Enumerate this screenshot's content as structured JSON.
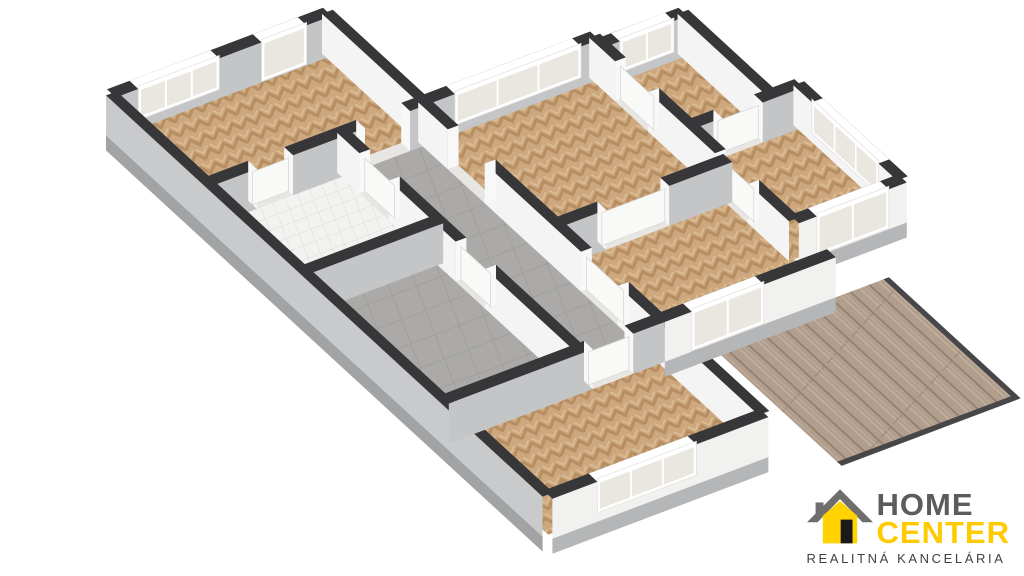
{
  "branding": {
    "line1": "HOME",
    "line2": "CENTER",
    "tagline": "REALITNÁ KANCELÁRIA",
    "colors": {
      "home_gray": "#5C5C5C",
      "center_yellow": "#FFCB00",
      "tagline_dark": "#3F3F3F",
      "roof_gray": "#6E6E6E",
      "house_yellow": "#FFD200",
      "door_black": "#1A1A1A"
    }
  },
  "floorplan": {
    "projection": {
      "origin": [
        95,
        130
      ],
      "u": [
        0.9,
        -0.34
      ],
      "v": [
        0.74,
        0.68
      ],
      "wall_height": 40,
      "slab_height": 15,
      "wall_thickness": 12
    },
    "palette": {
      "cap": "#37373A",
      "face_gray": "#C3C5C7",
      "face_white": "#F4F4F4",
      "ext_sw": "#C8CACB",
      "ext_sw_slab": "#A2A3A4",
      "ext_se": "#F1F1F0",
      "ext_se_slab": "#B5B6B7",
      "jamb": "#F8F8F8",
      "threshold": "#E7E6E3",
      "door_leaf": "#F9F9F8",
      "door_leaf_edge": "#D8D8D6",
      "window_frame": "#FFFFFF",
      "window_frame_edge": "#E2E2E0",
      "window_pane": "#EAE7E0",
      "deck_rim": "#47474A",
      "wood_base": "#CDA87E",
      "wood_dark": "#B68E61",
      "wood_light": "#DCBE96",
      "gray_base": "#ABAAA8",
      "gray_line": "#9A9996",
      "bath_base": "#F2F2F0",
      "bath_line": "#DBDBD6",
      "deck_base": "#B19E8C",
      "deck_dark": "#8F7E6E",
      "deck_light": "#C7B6A3"
    },
    "rooms": [
      {
        "name": "bedroom-left",
        "rect": [
          10,
          10,
          160,
          140
        ],
        "floor": "wood"
      },
      {
        "name": "entry-hall",
        "rect": [
          160,
          10,
          250,
          140
        ],
        "floor": "wood"
      },
      {
        "name": "bathroom",
        "rect": [
          10,
          140,
          160,
          270
        ],
        "floor": "bath"
      },
      {
        "name": "utility-room",
        "rect": [
          10,
          270,
          160,
          460
        ],
        "floor": "gray"
      },
      {
        "name": "corridor",
        "rect": [
          160,
          140,
          250,
          460
        ],
        "floor": "gray"
      },
      {
        "name": "living-room",
        "rect": [
          250,
          140,
          440,
          320
        ],
        "floor": "wood"
      },
      {
        "name": "bedroom-top",
        "rect": [
          440,
          150,
          530,
          270
        ],
        "floor": "wood"
      },
      {
        "name": "bedroom-east",
        "rect": [
          440,
          270,
          560,
          410
        ],
        "floor": "wood"
      },
      {
        "name": "room-middle",
        "rect": [
          250,
          320,
          440,
          460
        ],
        "floor": "wood"
      },
      {
        "name": "bedroom-south",
        "rect": [
          10,
          460,
          250,
          600
        ],
        "floor": "wood"
      }
    ],
    "terrace": {
      "rect": [
        300,
        466,
        495,
        640
      ]
    },
    "walls": [
      {
        "id": "nw-facade-left",
        "a": [
          10,
          10
        ],
        "b": [
          250,
          10
        ],
        "kind": "int",
        "wins": [
          {
            "t": [
              35,
              125
            ],
            "panes": 3
          },
          {
            "t": [
              172,
              222
            ],
            "panes": 1,
            "door": true
          }
        ],
        "gaps": []
      },
      {
        "id": "nw-facade-living",
        "a": [
          250,
          140
        ],
        "b": [
          440,
          140
        ],
        "kind": "int",
        "wins": [
          {
            "t": [
              280,
              420
            ],
            "panes": 3
          }
        ],
        "gaps": []
      },
      {
        "id": "nw-facade-bedtop",
        "a": [
          440,
          150
        ],
        "b": [
          530,
          150
        ],
        "kind": "int",
        "wins": [
          {
            "t": [
              455,
              515
            ],
            "panes": 2
          }
        ],
        "gaps": []
      },
      {
        "id": "wall-bedleft-bath",
        "a": [
          10,
          140
        ],
        "b": [
          250,
          140
        ],
        "kind": "int",
        "wins": [],
        "gaps": [
          {
            "t": [
              60,
              100
            ],
            "leaf": true
          },
          {
            "t": [
              180,
              230
            ],
            "leaf": false
          }
        ]
      },
      {
        "id": "wall-bath-utility",
        "a": [
          10,
          270
        ],
        "b": [
          160,
          270
        ],
        "kind": "int",
        "wins": [],
        "gaps": []
      },
      {
        "id": "wall-corr-bedsouth",
        "a": [
          10,
          460
        ],
        "b": [
          250,
          460
        ],
        "kind": "int",
        "wins": [],
        "gaps": [
          {
            "t": [
              170,
              215
            ],
            "leaf": true
          }
        ]
      },
      {
        "id": "wall-living-mid",
        "a": [
          250,
          320
        ],
        "b": [
          440,
          320
        ],
        "kind": "int",
        "wins": [],
        "gaps": [
          {
            "t": [
              300,
              370
            ],
            "leaf": true
          }
        ]
      },
      {
        "id": "wall-bedtop-bedeast",
        "a": [
          440,
          270
        ],
        "b": [
          560,
          270
        ],
        "kind": "int",
        "wins": [],
        "gaps": [
          {
            "t": [
              470,
              515
            ],
            "leaf": true
          }
        ]
      },
      {
        "id": "se-facade-roommid",
        "a": [
          250,
          460
        ],
        "b": [
          440,
          460
        ],
        "kind": "ext-se",
        "wins": [
          {
            "t": [
              280,
              360
            ],
            "panes": 2,
            "door": true
          }
        ],
        "gaps": []
      },
      {
        "id": "se-facade-bedsouth",
        "a": [
          10,
          600
        ],
        "b": [
          250,
          600
        ],
        "kind": "ext-se",
        "wins": [
          {
            "t": [
              60,
              170
            ],
            "panes": 3
          }
        ],
        "gaps": []
      },
      {
        "id": "se-facade-bedeast",
        "a": [
          440,
          410
        ],
        "b": [
          560,
          410
        ],
        "kind": "ext-se",
        "wins": [
          {
            "t": [
              460,
              540
            ],
            "panes": 2,
            "door": true
          }
        ],
        "gaps": []
      },
      {
        "id": "sw-facade",
        "a": [
          10,
          10
        ],
        "b": [
          10,
          600
        ],
        "kind": "ext-sw",
        "wins": [],
        "gaps": []
      },
      {
        "id": "ne-wall-entry",
        "a": [
          250,
          10
        ],
        "b": [
          250,
          140
        ],
        "kind": "int",
        "wins": [],
        "gaps": []
      },
      {
        "id": "wall-corridor-west",
        "a": [
          160,
          140
        ],
        "b": [
          160,
          460
        ],
        "kind": "int",
        "wins": [],
        "gaps": [
          {
            "t": [
              170,
              210
            ],
            "leaf": true
          },
          {
            "t": [
              300,
              340
            ],
            "leaf": true
          }
        ]
      },
      {
        "id": "wall-corridor-east",
        "a": [
          250,
          140
        ],
        "b": [
          250,
          600
        ],
        "kind": "int",
        "wins": [],
        "gaps": [
          {
            "t": [
              180,
              230
            ],
            "leaf": false
          },
          {
            "t": [
              360,
              410
            ],
            "leaf": true
          }
        ]
      },
      {
        "id": "wall-living-east",
        "a": [
          440,
          140
        ],
        "b": [
          440,
          410
        ],
        "kind": "int",
        "wins": [],
        "gaps": [
          {
            "t": [
              175,
              220
            ],
            "leaf": true
          },
          {
            "t": [
              310,
              355
            ],
            "leaf": true
          }
        ]
      },
      {
        "id": "ne-facade-bedtop",
        "a": [
          530,
          150
        ],
        "b": [
          530,
          270
        ],
        "kind": "int",
        "wins": [],
        "gaps": []
      },
      {
        "id": "ne-facade-bedeast",
        "a": [
          560,
          270
        ],
        "b": [
          560,
          410
        ],
        "kind": "int",
        "wins": [
          {
            "t": [
              295,
              385
            ],
            "panes": 3
          }
        ],
        "gaps": []
      }
    ]
  }
}
